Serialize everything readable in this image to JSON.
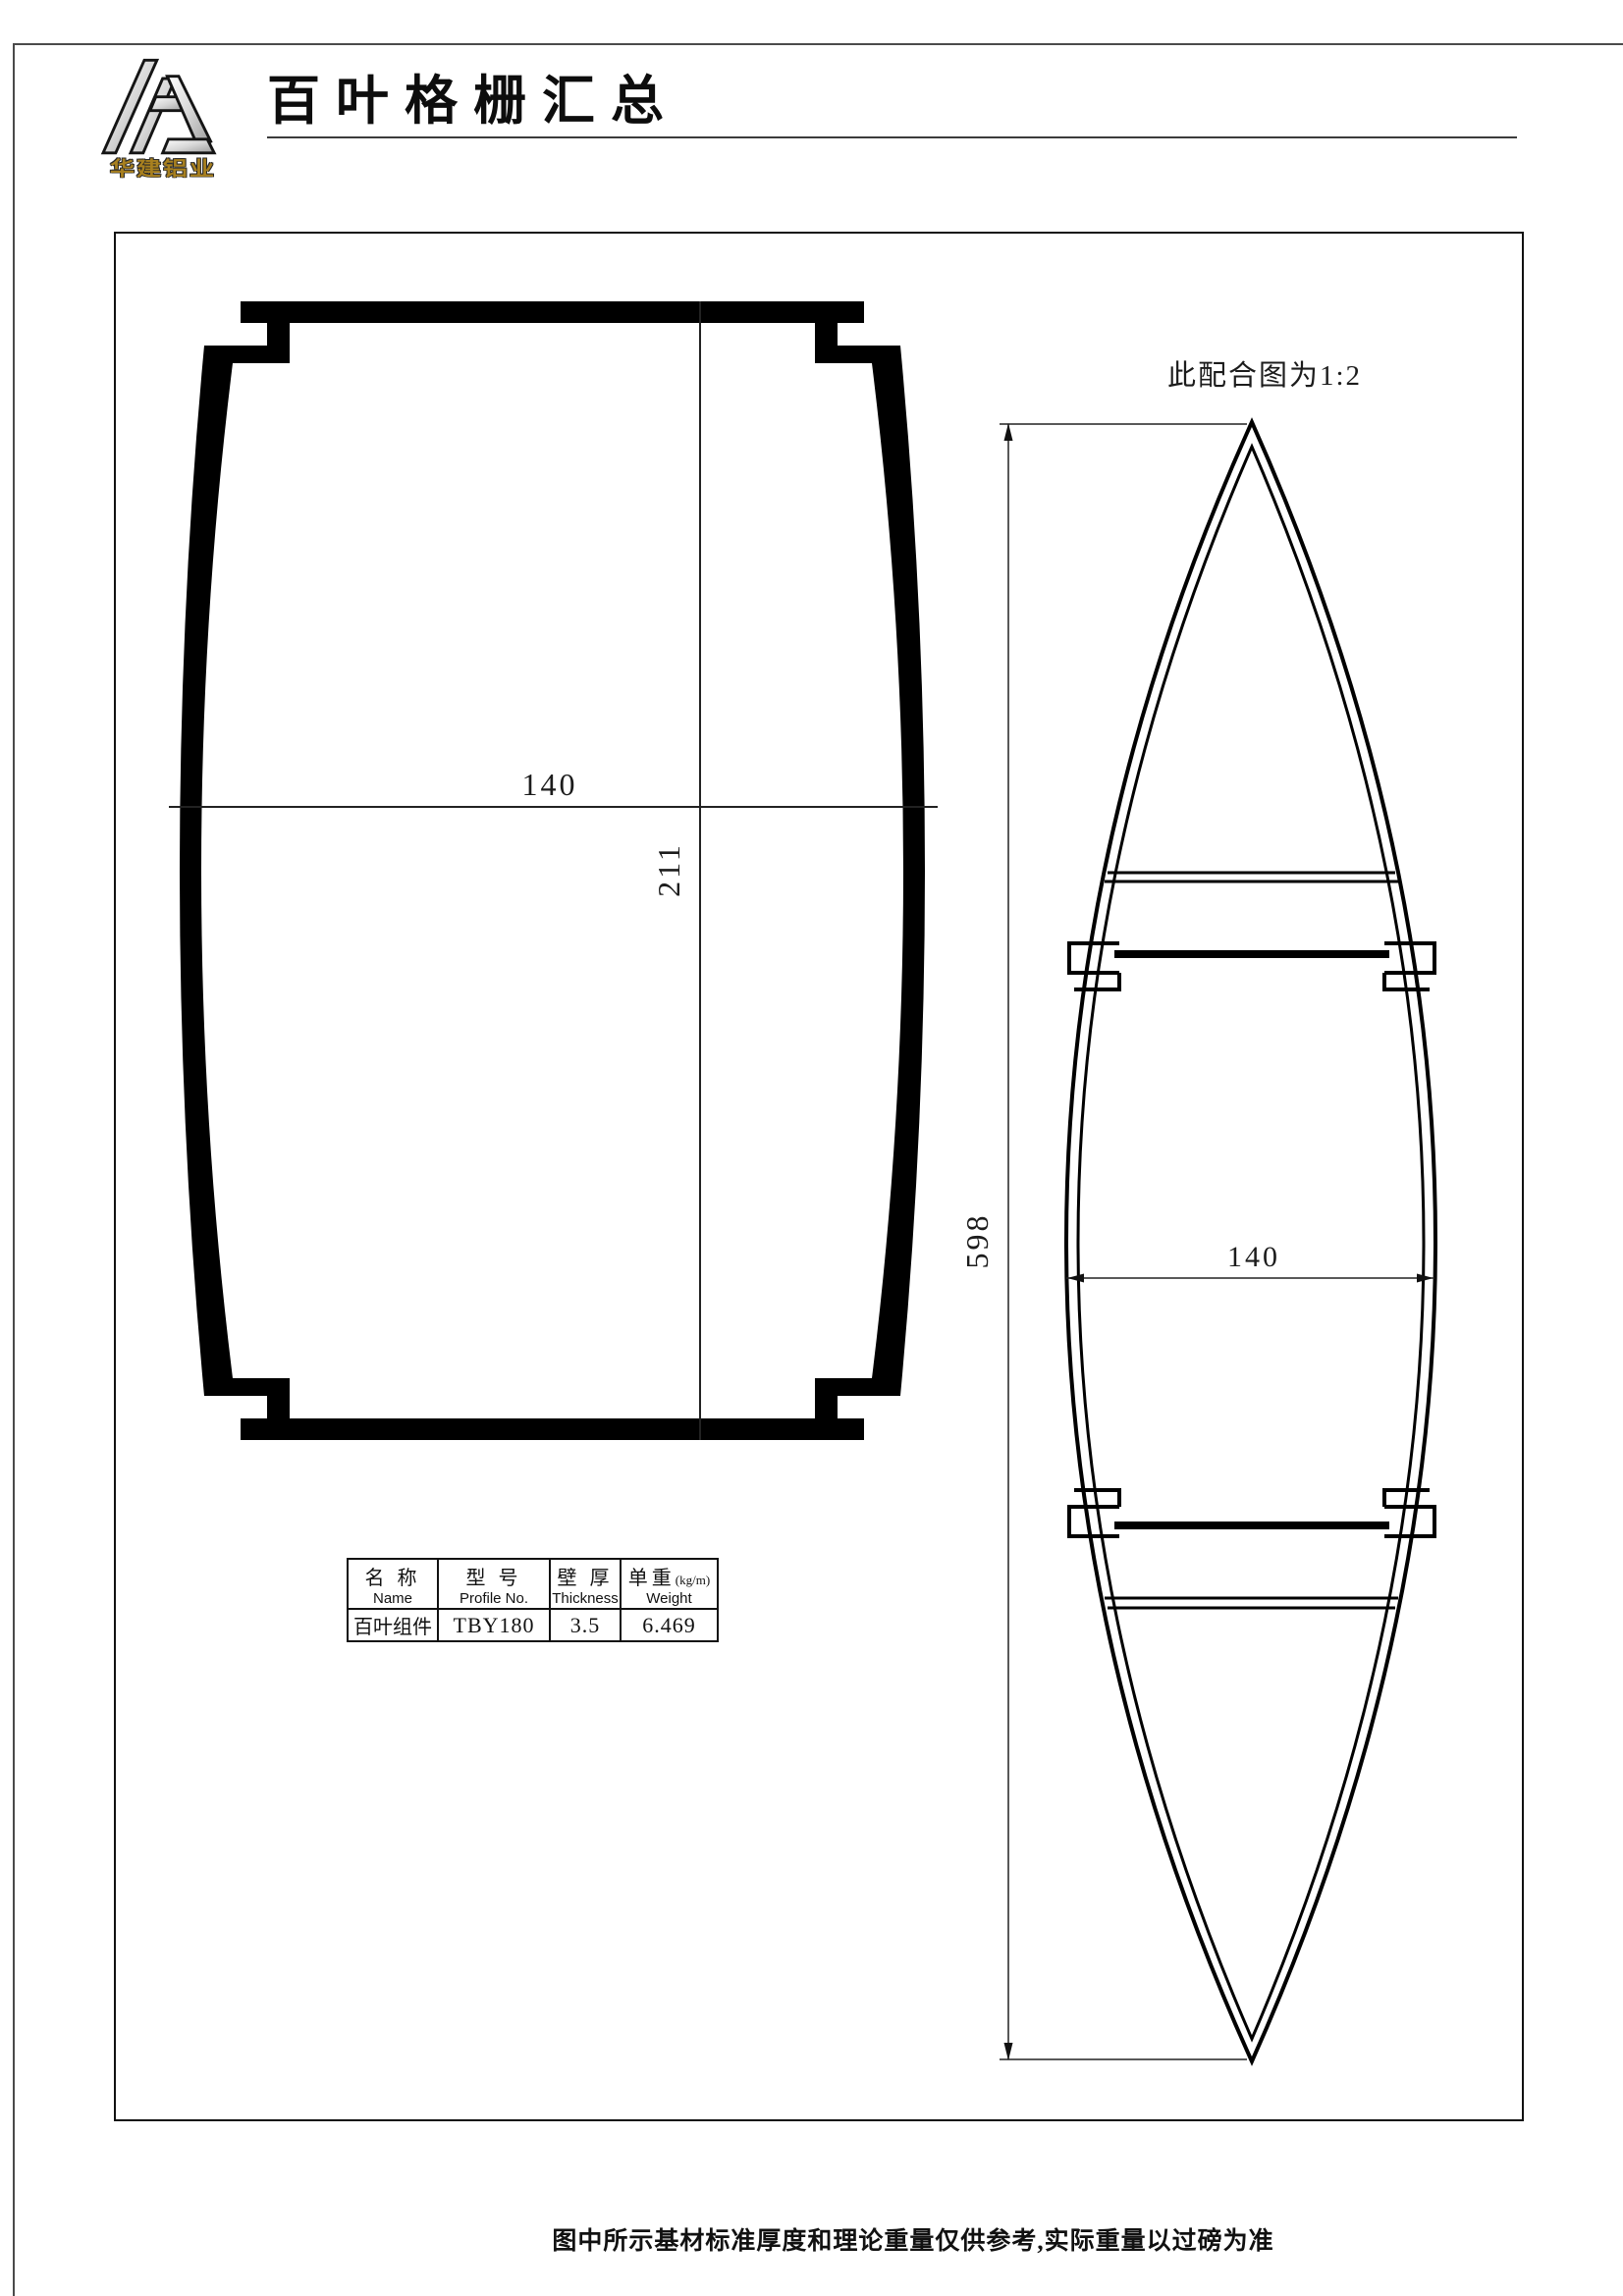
{
  "header": {
    "company_name": "华建铝业",
    "title": "百叶格栅汇总"
  },
  "drawing": {
    "scale_note": "此配合图为1:2",
    "left_profile": {
      "width_dim": "140",
      "height_dim": "211"
    },
    "right_profile": {
      "length_dim": "598",
      "width_dim": "140"
    }
  },
  "spec_table": {
    "columns": [
      {
        "cn": "名 称",
        "unit": "",
        "en": "Name"
      },
      {
        "cn": "型 号",
        "unit": "",
        "en": "Profile No."
      },
      {
        "cn": "壁 厚",
        "unit": "",
        "en": "Thickness"
      },
      {
        "cn": "单重",
        "unit": "(kg/m)",
        "en": "Weight"
      }
    ],
    "rows": [
      [
        "百叶组件",
        "TBY180",
        "3.5",
        "6.469"
      ]
    ]
  },
  "footer": {
    "note": "图中所示基材标准厚度和理论重量仅供参考,实际重量以过磅为准"
  },
  "colors": {
    "line": "#111111",
    "gold": "#a8801f"
  }
}
